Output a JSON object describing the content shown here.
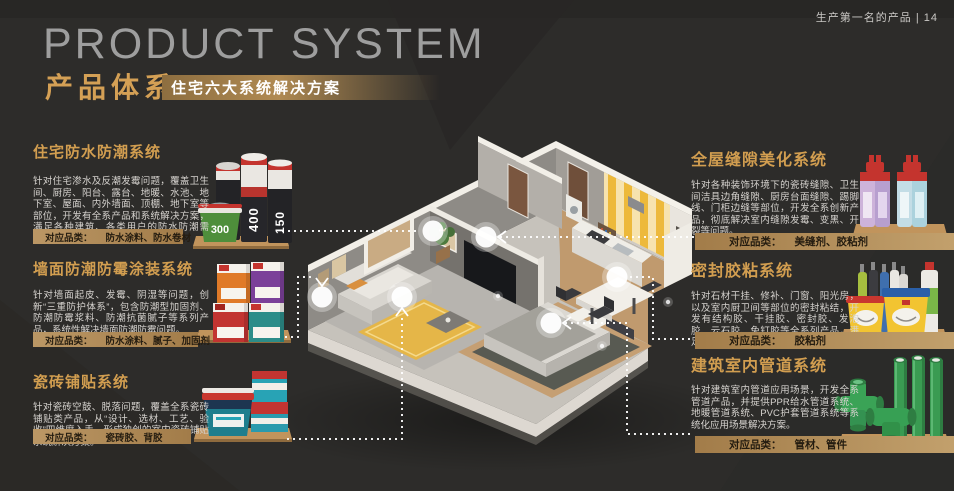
{
  "page": {
    "corner_label": "生产第一名的产品 | 14"
  },
  "header": {
    "title_en": "PRODUCT SYSTEM",
    "title_zh": "产品体系",
    "banner": "住宅六大系统解决方案"
  },
  "labels": {
    "category": "对应品类："
  },
  "sections": [
    {
      "title": "住宅防水防潮系统",
      "desc": "针对住宅渗水及反潮发霉问题，覆盖卫生间、厨房、阳台、露台、地暖、水池、地下室、屋面、内外墙面、顶棚、地下室等部位，开发有全系产品和系统解决方案，满足各种建筑、各类用户的防水防潮需求。",
      "categories": "防水涂料、防水卷材"
    },
    {
      "title": "墙面防潮防霉涂装系统",
      "desc": "针对墙面起皮、发霉、阴湿等问题，创新“三重防护体系”，包含防潮型加固剂、防潮防霉浆料、防潮抗菌腻子等系列产品，系统性解决墙面防潮防霉问题。",
      "categories": "防水涂料、腻子、加固剂"
    },
    {
      "title": "瓷砖铺贴系统",
      "desc": "针对瓷砖空鼓、脱落问题，覆盖全系瓷砖铺贴类产品，从“设计、选材、工艺、验收”四维度入手，形成独创的室内瓷砖铺贴系统解决方案。",
      "categories": "瓷砖胶、背胶"
    },
    {
      "title": "全屋缝隙美化系统",
      "desc": "针对各种装饰环境下的瓷砖缝隙、卫生间洁具边角缝隙、厨房台面缝隙、踢脚线、门柜边缝等部位，开发全系创新产品，彻底解决室内缝隙发霉、变黑、开裂等问题。",
      "categories": "美缝剂、胶粘剂"
    },
    {
      "title": "密封胶粘系统",
      "desc": "针对石材干挂、修补、门窗、阳光房，以及室内厨卫间等部位的密封粘结，开发有结构胶、干挂胶、密封胶、发泡胶、云石胶、免钉胶等全系列产品，满足各类密封胶粘需求。",
      "categories": "胶粘剂"
    },
    {
      "title": "建筑室内管道系统",
      "desc": "针对建筑室内管道应用场景，开发全系管道产品，并提供PPR给水管道系统、地暖管道系统、PVC护套管道系统等系统化应用场景解决方案。",
      "categories": "管材、管件"
    }
  ],
  "products": {
    "roll_400": "400",
    "roll_150": "150",
    "bucket_300": "300"
  },
  "colors": {
    "background": "#2d2c2a",
    "gold_title": "#d29e50",
    "gold_bar": "#b18c58",
    "rug_yellow": "#e5b648",
    "pipe_green": "#3a9b52"
  }
}
